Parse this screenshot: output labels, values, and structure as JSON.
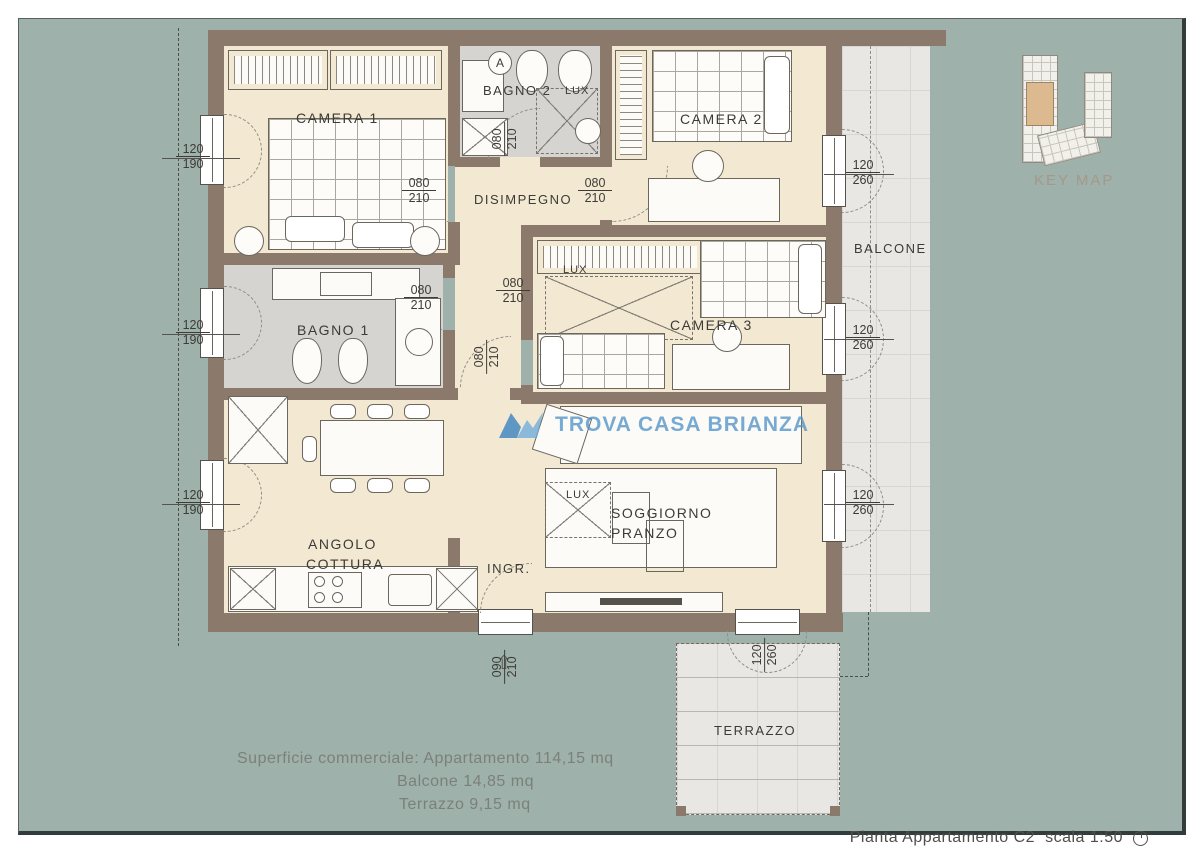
{
  "frame": {
    "title": "Pianta Appartamento C2",
    "scale": "scala 1:50"
  },
  "key_map": {
    "label": "KEY MAP"
  },
  "watermark": {
    "text": "TROVA CASA BRIANZA"
  },
  "summary": {
    "line1": "Superficie commerciale: Appartamento 114,15 mq",
    "line2": "Balcone 14,85 mq",
    "line3": "Terrazzo 9,15 mq"
  },
  "rooms": {
    "camera1": "CAMERA 1",
    "camera2": "CAMERA 2",
    "camera3": "CAMERA 3",
    "bagno1": "BAGNO 1",
    "bagno2": "BAGNO 2",
    "disimpegno": "DISIMPEGNO",
    "angolo1": "ANGOLO",
    "angolo2": "COTTURA",
    "soggiorno1": "SOGGIORNO",
    "soggiorno2": "PRANZO",
    "ingresso": "INGR.",
    "balcone": "BALCONE",
    "terrazzo": "TERRAZZO",
    "lux": "LUX",
    "marker_a": "A"
  },
  "dims": {
    "w120_190": {
      "top": "120",
      "bottom": "190"
    },
    "w120_260": {
      "top": "120",
      "bottom": "260"
    },
    "d080_210": {
      "top": "080",
      "bottom": "210"
    },
    "d090_210": {
      "top": "090",
      "bottom": "210"
    }
  },
  "symbols": {
    "entry_arrow": "⇧"
  },
  "colors": {
    "wall": "#8b796c",
    "floor": "#f3e9d2",
    "background": "#9eb1ab",
    "watermark_blue": "#4b90c8"
  }
}
